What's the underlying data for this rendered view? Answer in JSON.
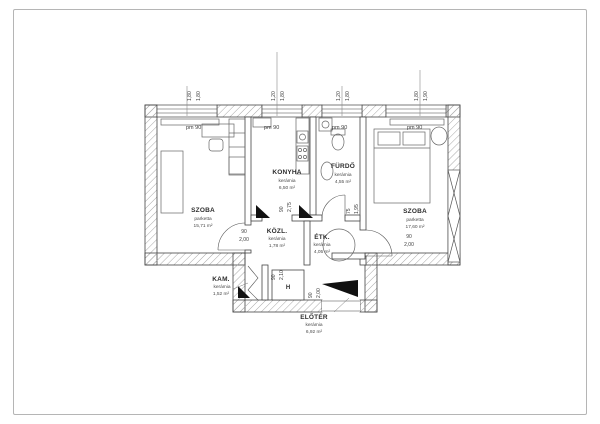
{
  "plan": {
    "rooms": [
      {
        "name": "SZOBA",
        "floor": "parketta",
        "area": "15,71 m²"
      },
      {
        "name": "KONYHA",
        "floor": "kerámia",
        "area": "6,50 m²"
      },
      {
        "name": "FÜRDŐ",
        "floor": "kerámia",
        "area": "4,55 m²"
      },
      {
        "name": "SZOBA",
        "floor": "parketta",
        "area": "17,60 m²"
      },
      {
        "name": "KÖZL.",
        "floor": "kerámia",
        "area": "1,78 m²"
      },
      {
        "name": "ÉTK.",
        "floor": "kerámia",
        "area": "4,05 m²"
      },
      {
        "name": "KAM.",
        "floor": "kerámia",
        "area": "1,52 m²"
      },
      {
        "name": "ELŐTÉR",
        "floor": "kerámia",
        "area": "6,92 m²"
      }
    ],
    "sill_labels": [
      "pm 90",
      "pm 90",
      "pm 90",
      "pm 90"
    ],
    "window_dims": [
      {
        "a": "1,80",
        "b": "1,80"
      },
      {
        "a": "1,20",
        "b": "1,80"
      },
      {
        "a": "1,20",
        "b": "1,80"
      },
      {
        "a": "1,80",
        "b": "1,90"
      }
    ],
    "door_dims": [
      {
        "w": "90",
        "h": "2,00"
      },
      {
        "w": "90",
        "h": "2,75"
      },
      {
        "w": "75",
        "h": "1,95"
      },
      {
        "w": "90",
        "h": "2,00"
      },
      {
        "w": "90",
        "h": "2,10"
      },
      {
        "w": "90",
        "h": "2,00"
      }
    ],
    "closet_label": "H",
    "colors": {
      "line": "#444444",
      "hatch": "#a8a8a8",
      "furniture": "#666666",
      "page_border": "#b5b5b5"
    }
  }
}
